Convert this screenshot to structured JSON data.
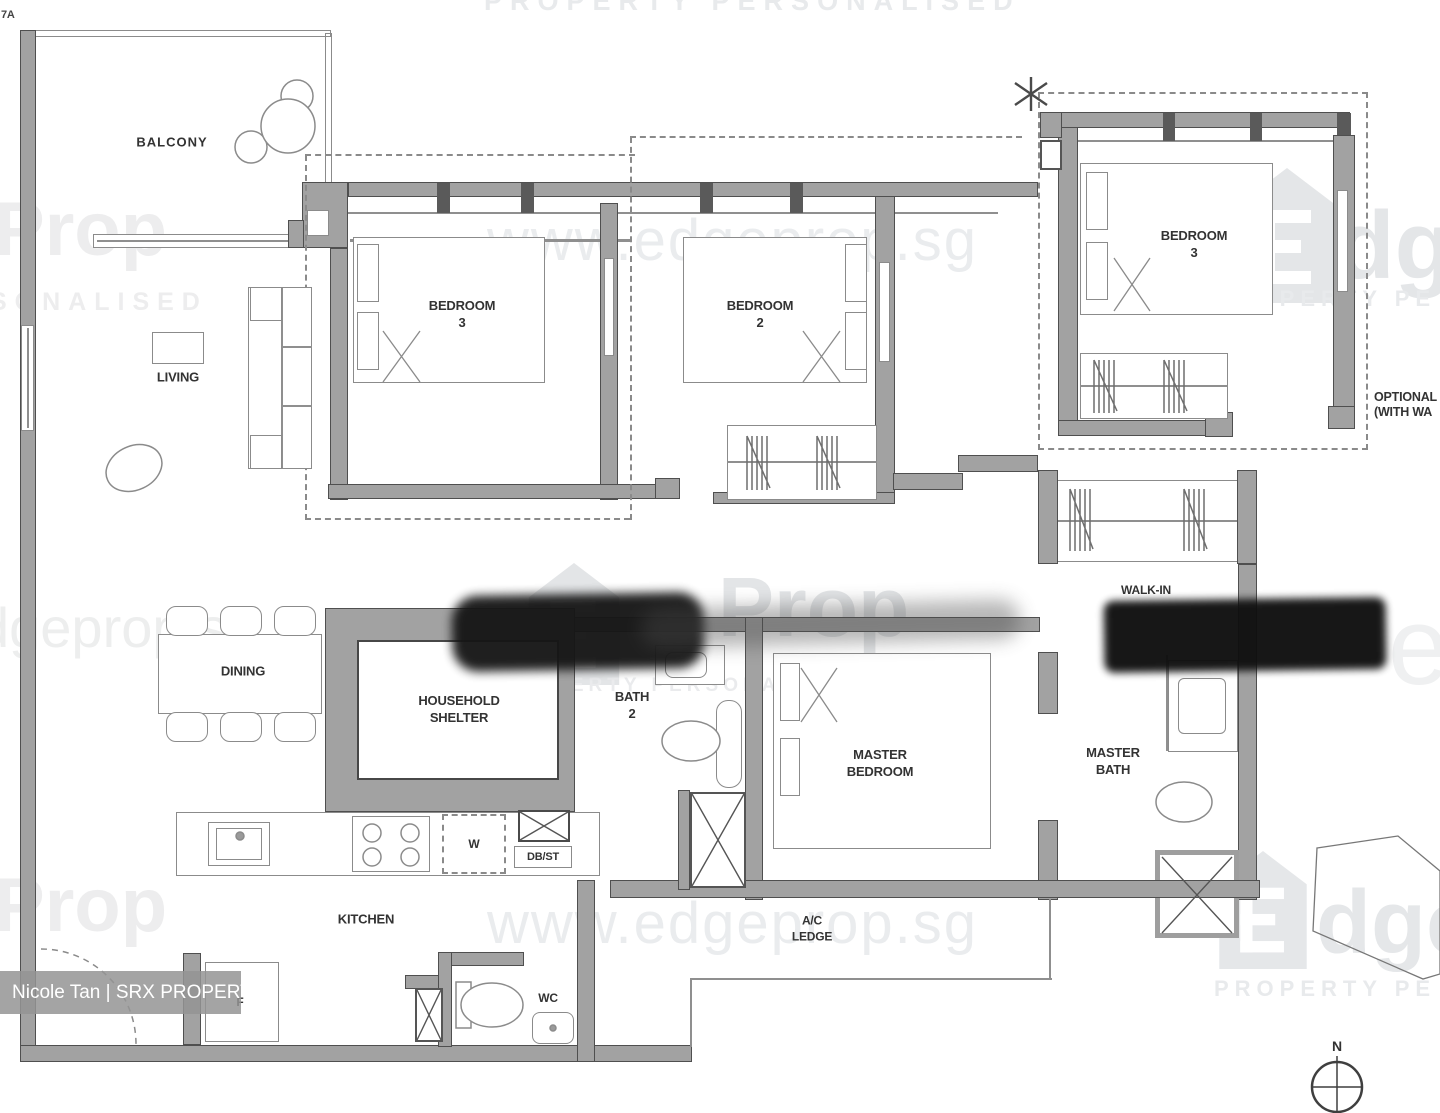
{
  "corner_label": "7A",
  "rooms": {
    "balcony": "BALCONY",
    "living": "LIVING",
    "dining": "DINING",
    "kitchen": "KITCHEN",
    "bedroom3": "BEDROOM\n3",
    "bedroom2": "BEDROOM\n2",
    "bedroom3_optional": "BEDROOM\n3",
    "master_bedroom": "MASTER\nBEDROOM",
    "master_bath": "MASTER\nBATH",
    "walk_in": "WALK-IN",
    "bath2": "BATH\n2",
    "household_shelter": "HOUSEHOLD\nSHELTER",
    "wc": "WC",
    "ac_ledge": "A/C\nLEDGE"
  },
  "appliances": {
    "washer": "W",
    "fridge": "F",
    "db_st": "DB/ST"
  },
  "annotations": {
    "optional_note": "OPTIONAL\n(WITH WA",
    "compass_north": "N"
  },
  "watermarks": {
    "tagline": "PROPERTY PERSONALISED",
    "url": "www.edgeprop.sg",
    "brand_prop": "Prop",
    "brand_dge": "dge",
    "brand_e": "e",
    "tagline_partial": "PROPERTY PE",
    "sonalised": "SONALISED",
    "dgeprop": "dgeprop.sg"
  },
  "credit": "Nicole Tan | SRX PROPERTY",
  "colors": {
    "wall": "#a2a2a2",
    "wall_edge": "#4f4f4f",
    "line": "#8f8f8f",
    "label": "#333333",
    "watermark": "#e8eaec",
    "redaction": "#141414",
    "credit_band": "#949494",
    "credit_text": "#ffffff"
  }
}
